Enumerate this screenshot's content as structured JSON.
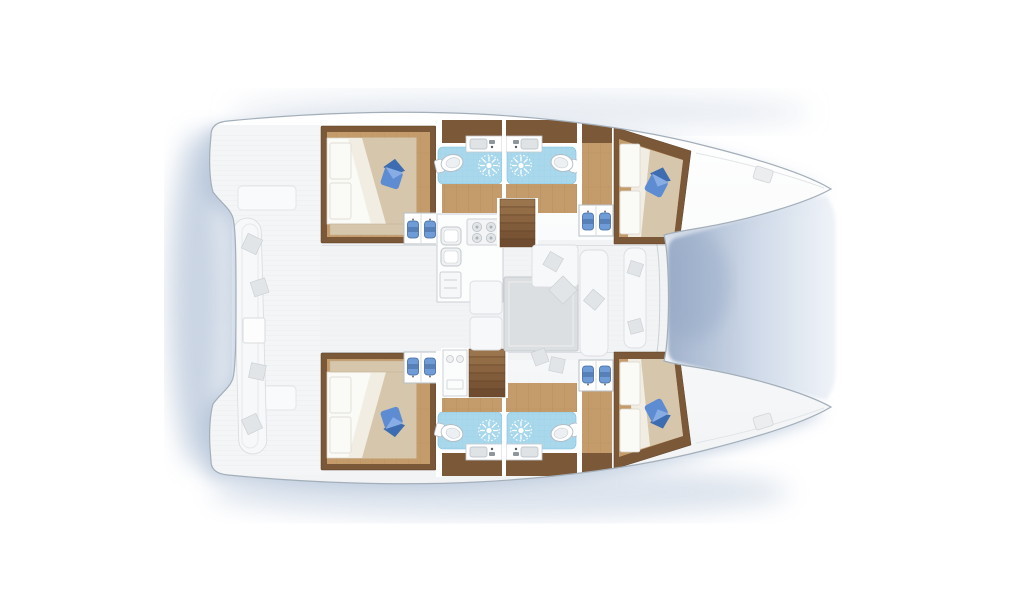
{
  "meta": {
    "figure_type": "yacht-deck-floorplan",
    "vessel_type": "catamaran",
    "orientation": "bow-right",
    "visible_text": []
  },
  "canvas": {
    "width": 1024,
    "height": 600
  },
  "colors": {
    "bg": "#ffffff",
    "shadow": "#b3c3d8",
    "shadow_dark": "#9fb2cd",
    "hull_fill_top": "#ffffff",
    "hull_fill_bot": "#f1f3f5",
    "hull_stroke": "#a3aeb9",
    "deck_line": "#e9ebed",
    "faded_fill": "#f4f5f6",
    "faded_dark": "#e2e5e8",
    "wood_dark": "#7a5838",
    "wood_floor": "#c49c6c",
    "wood_line": "#a9824f",
    "linen": "#fafaf6",
    "linen2": "#f1ede3",
    "duvet": "#d6c7ac",
    "duvet_dark": "#bfae8f",
    "pillow_blue": "#5d8cd3",
    "pillow_blue_dark": "#3e6cb0",
    "pillow_blue_light": "#8fb2e6",
    "shower": "#a9d8ec",
    "shower_line": "#7fc2dd",
    "shirt_blue": "#6f9bd6",
    "shirt_blue_dark": "#41699f",
    "stair_top": "#9a744c",
    "stair_bottom": "#6f4c2f",
    "tramp_dark": "#9dafca",
    "tramp_mid": "#cfdae9",
    "tramp_light": "#f0f4f9"
  },
  "layout": {
    "hulls": 2,
    "cabins": [
      {
        "name": "port-aft-cabin",
        "bed": "double",
        "accent_pillow": "blue",
        "wardrobe": true
      },
      {
        "name": "port-forward-cabin",
        "bed": "double",
        "accent_pillow": "blue",
        "wardrobe": true
      },
      {
        "name": "starboard-aft-cabin",
        "bed": "double",
        "accent_pillow": "blue",
        "wardrobe": true
      },
      {
        "name": "starboard-forward-cabin",
        "bed": "double",
        "accent_pillow": "blue",
        "wardrobe": true
      }
    ],
    "heads_per_hull": {
      "toilets": 2,
      "shower_drains": 2,
      "vanity_sinks": 2
    },
    "saloon": {
      "galley": [
        "four-burner-stove",
        "double-sink",
        "lower-cabinet"
      ],
      "dining_table": true,
      "companionway_stairs": 2
    },
    "cockpit": {
      "curved_bench": true,
      "scatter_pillows": 4,
      "small_table": true
    },
    "foredeck": {
      "trampoline": true,
      "deck_hatches": 2
    }
  }
}
